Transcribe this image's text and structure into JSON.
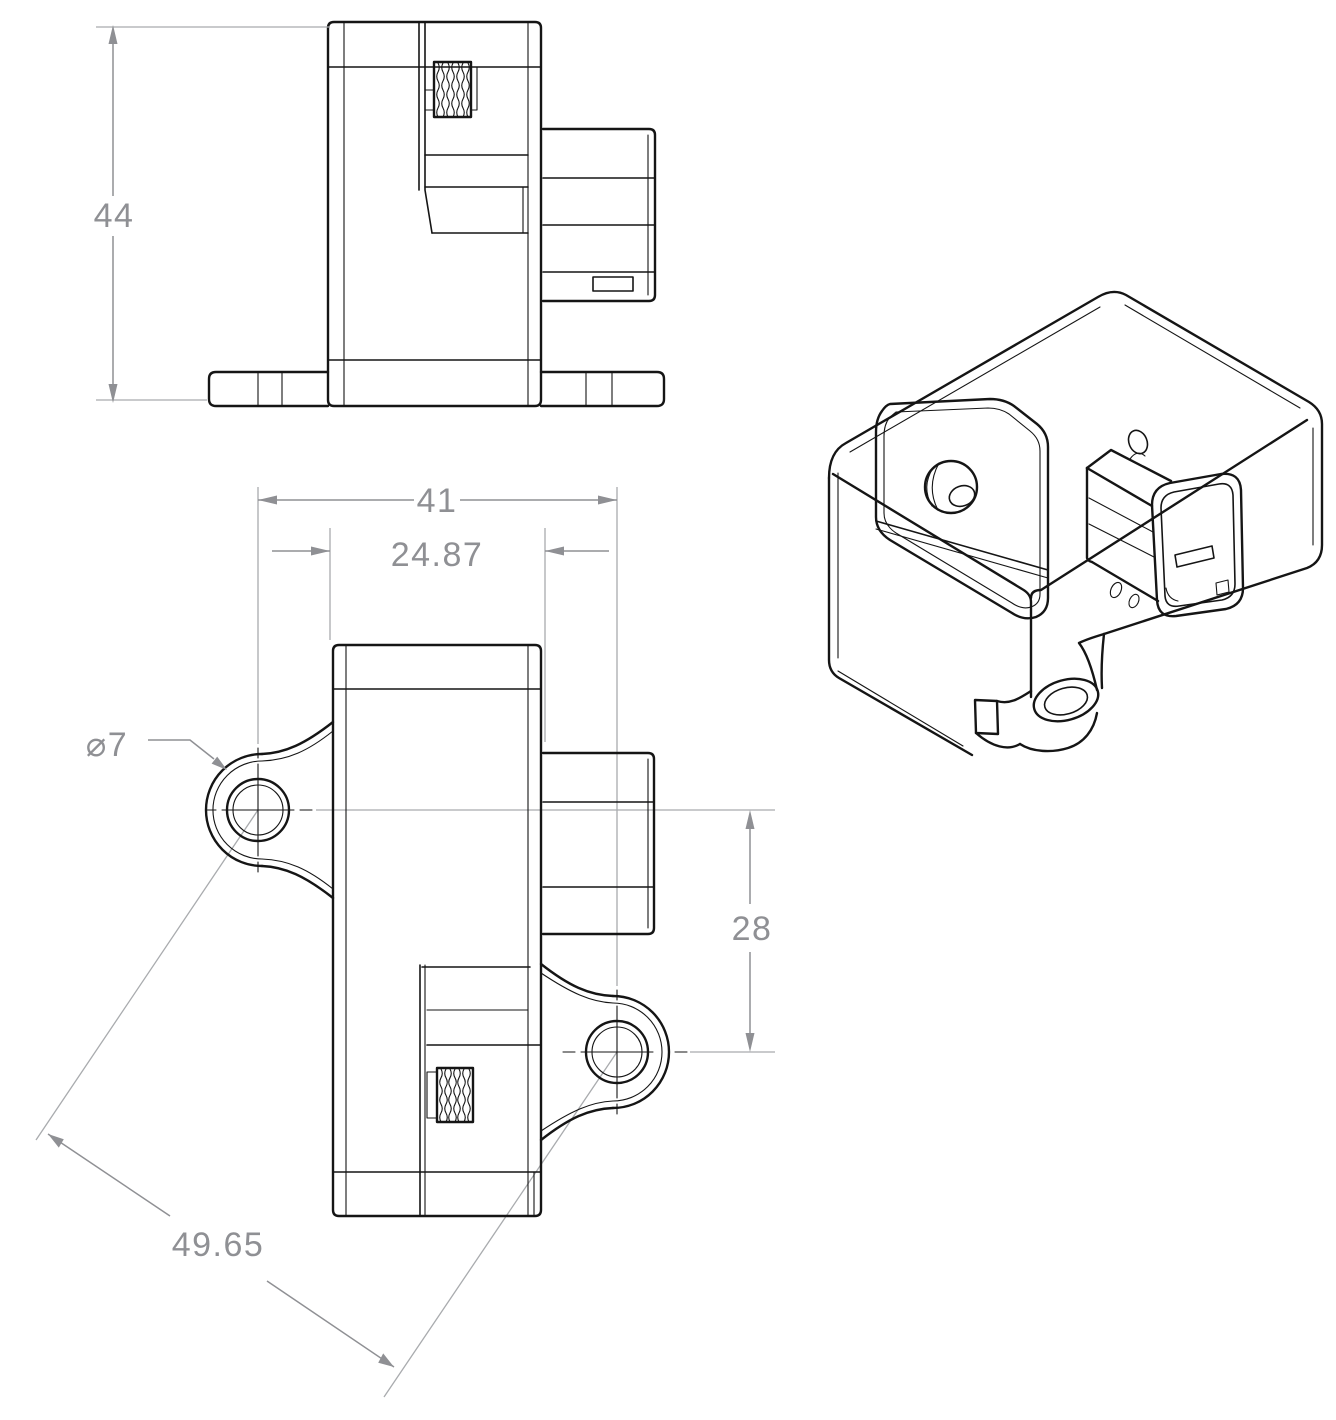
{
  "colors": {
    "background": "#ffffff",
    "part_line": "#151515",
    "dimension": "#8f9094",
    "extension_line": "#a9abae"
  },
  "front_view": {
    "dim_overall_height": "44"
  },
  "top_view": {
    "dim_hole_span_horizontal": "41",
    "dim_body_width": "24.87",
    "dim_hole_diameter": "⌀7",
    "dim_hole_span_vertical": "28",
    "dim_hole_span_diagonal": "49.65"
  }
}
